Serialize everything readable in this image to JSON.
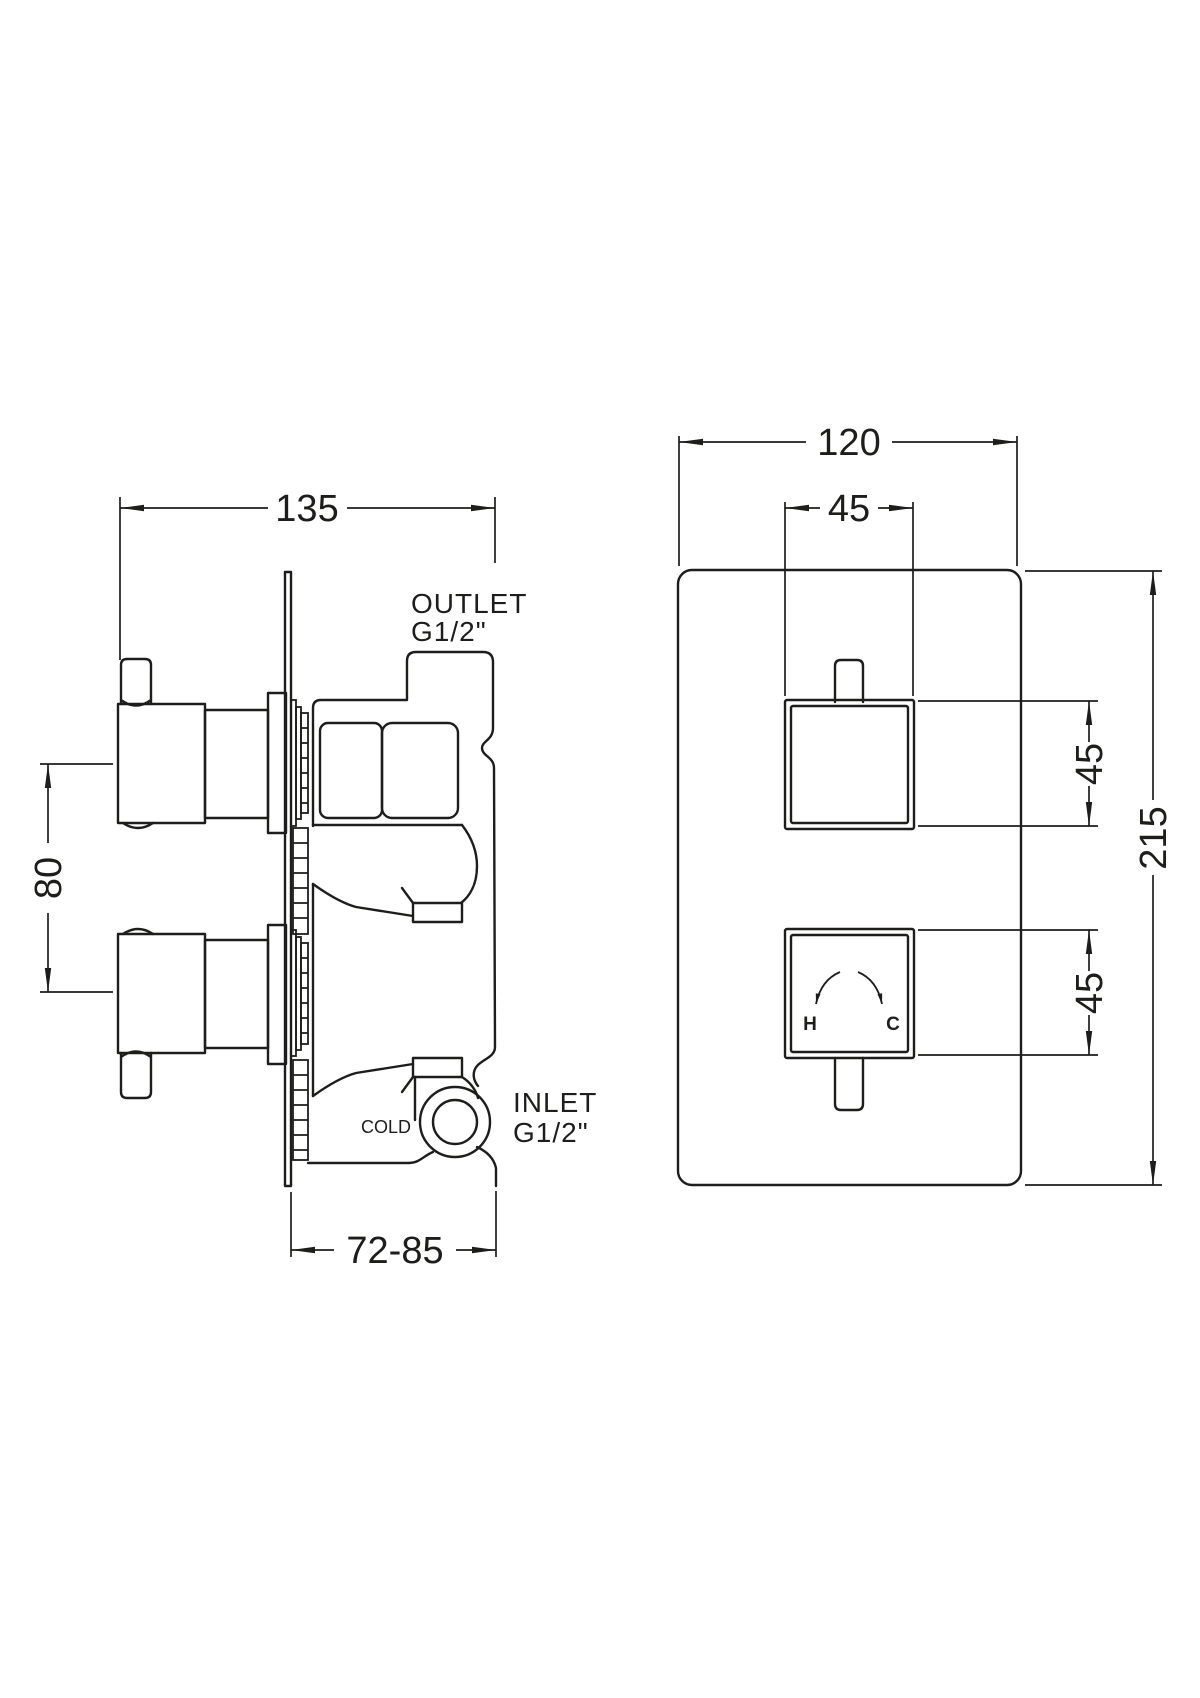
{
  "title": "Thermostatic shower valve technical drawing",
  "colors": {
    "ink": "#1d1d1b",
    "background": "#ffffff"
  },
  "side_view": {
    "dim_width": "135",
    "dim_handle_spacing": "80",
    "dim_depth": "72-85",
    "outlet_label_line1": "OUTLET",
    "outlet_label_line2": "G1/2\"",
    "inlet_label_line1": "INLET",
    "inlet_label_line2": "G1/2\"",
    "cold_label": "COLD"
  },
  "front_view": {
    "dim_plate_width": "120",
    "dim_knob_width": "45",
    "dim_knob_top": "45",
    "dim_knob_bottom": "45",
    "dim_plate_height": "215",
    "hot_label": "H",
    "cold_label": "C"
  }
}
